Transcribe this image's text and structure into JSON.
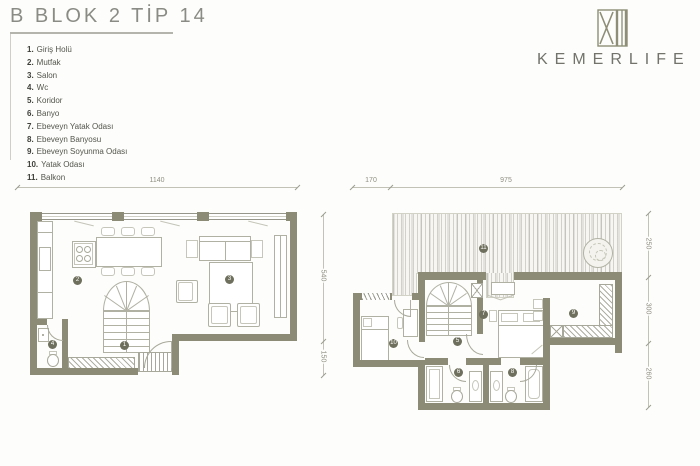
{
  "page": {
    "title": "B BLOK 2 TİP 14"
  },
  "legend": {
    "items": [
      {
        "n": "1.",
        "label": "Giriş Holü"
      },
      {
        "n": "2.",
        "label": "Mutfak"
      },
      {
        "n": "3.",
        "label": "Salon"
      },
      {
        "n": "4.",
        "label": "Wc"
      },
      {
        "n": "5.",
        "label": "Koridor"
      },
      {
        "n": "6.",
        "label": "Banyo"
      },
      {
        "n": "7.",
        "label": "Ebeveyn Yatak Odası"
      },
      {
        "n": "8.",
        "label": "Ebeveyn Banyosu"
      },
      {
        "n": "9.",
        "label": "Ebeveyn Soyunma Odası"
      },
      {
        "n": "10.",
        "label": "Yatak Odası"
      },
      {
        "n": "11.",
        "label": "Balkon"
      }
    ]
  },
  "logo": {
    "name": "KEMERLIFE",
    "mark": "XII"
  },
  "colors": {
    "wall": "#8c8c76",
    "badge": "#6f6f5d",
    "logo": "#8e8e76",
    "drawing_line": "#b0b0a3"
  },
  "floors": {
    "ground": {
      "dims": {
        "top": "1140",
        "right": [
          "540",
          "150"
        ]
      },
      "badges": {
        "giris": "1",
        "mutfak": "2",
        "salon": "3",
        "wc": "4"
      }
    },
    "upper": {
      "dims": {
        "top_left": "170",
        "top": "975",
        "right": [
          "250",
          "300",
          "260"
        ]
      },
      "badges": {
        "koridor": "5",
        "banyo": "6",
        "ebeveyn_yatak": "7",
        "ebeveyn_banyo": "8",
        "soyunma": "9",
        "yatak": "10",
        "balkon": "11"
      }
    }
  }
}
